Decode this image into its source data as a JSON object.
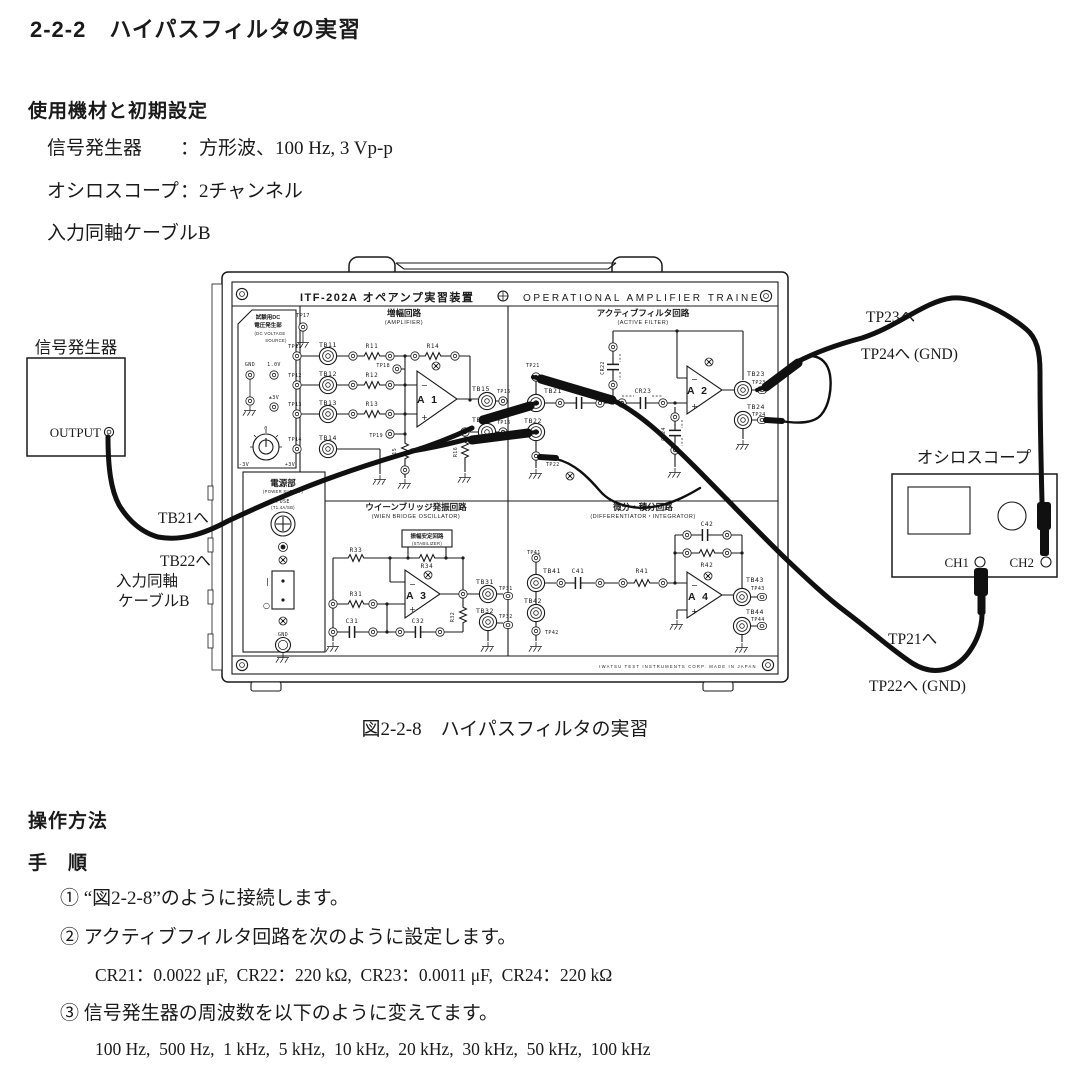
{
  "doc": {
    "title": "2-2-2　ハイパスフィルタの実習",
    "equipment_heading": "使用機材と初期設定",
    "equipment": [
      {
        "label": "信号発生器",
        "value": "：方形波、100 Hz, 3 Vp-p"
      },
      {
        "label": "オシロスコープ",
        "value": "：2チャンネル"
      },
      {
        "label": "入力同軸ケーブルB",
        "value": ""
      }
    ],
    "figure_caption": "図2-2-8　ハイパスフィルタの実習",
    "operation_heading": "操作方法",
    "procedure_heading": "手　順",
    "steps": {
      "s1": "① “図2-2-8”のように接続します。",
      "s2": "② アクティブフィルタ回路を次のように設定します。",
      "s2_detail": "CR21：0.0022 μF,  CR22：220 kΩ,  CR23：0.0011 μF,  CR24：220 kΩ",
      "s3": "③ 信号発生器の周波数を以下のように変えてます。",
      "s3_detail": "100 Hz,  500 Hz,  1 kHz,  5 kHz,  10 kHz,  20 kHz,  30 kHz,  50 kHz,  100 kHz"
    }
  },
  "L": {
    "itf": "ITF-202A オペアンプ実習装置",
    "oat": "OPERATIONAL AMPLIFIER TRAINER",
    "iwatsu": "IWATSU TEST INSTRUMENTS CORP.   MADE IN JAPAN",
    "dc_t1": "試験用DC",
    "dc_t2": "電圧発生部",
    "dc_t3": "(DC VOLTAGE",
    "dc_t4": "SOURCE)",
    "gnd": "GND",
    "v10": "1.0V",
    "pm3": "±3V",
    "m3": "-3V",
    "p3": "+3V",
    "zero": "0",
    "pw_t": "電源部",
    "pw_e": "(POWER SUPPLY)",
    "fuse": "FUSE",
    "fuse_r": "(T1.4A/SB)",
    "sw_on": "|",
    "sw_off": "○",
    "gnd2": "GND",
    "amp_t": "増幅回路",
    "amp_e": "(AMPLIFIER)",
    "tp11": "TP11",
    "tp12": "TP12",
    "tp13": "TP13",
    "tp14": "TP14",
    "tp15": "TP15",
    "tp16": "TP16",
    "tp17": "TP17",
    "tp18": "TP18",
    "tp19": "TP19",
    "tb11": "TB11",
    "tb12": "TB12",
    "tb13": "TB13",
    "tb14": "TB14",
    "tb15": "TB15",
    "tb16": "TB16",
    "r11": "R11",
    "r12": "R12",
    "r13": "R13",
    "r14": "R14",
    "r15": "R15",
    "r16": "R16",
    "a1": "A 1",
    "af_t": "アクティブフィルタ回路",
    "af_e": "(ACTIVE FILTER)",
    "tp21": "TP21",
    "tp22": "TP22",
    "tp23": "TP23",
    "tp24": "TP24",
    "tb21": "TB21",
    "tb22": "TB22",
    "tb23": "TB23",
    "tb24": "TB24",
    "cr22": "CR22",
    "cr23": "CR23",
    "cr24": "CR24",
    "a2": "A 2",
    "wb_t": "ウイーンブリッジ発振回路",
    "wb_e": "(WIEN BRIDGE OSCILLATOR)",
    "stab": "振幅安定回路",
    "stab_e": "(STABILIZER)",
    "r31": "R31",
    "r32": "R32",
    "r33": "R33",
    "r34": "R34",
    "c31": "C31",
    "c32": "C32",
    "tb31": "TB31",
    "tb32": "TB32",
    "tp31": "TP31",
    "tp32": "TP32",
    "a3": "A 3",
    "di_t": "微分・積分回路",
    "di_e": "(DIFFERENTIATOR・INTEGRATOR)",
    "c41": "C41",
    "c42": "C42",
    "r41": "R41",
    "r42": "R42",
    "tb41": "TB41",
    "tb42": "TB42",
    "tb43": "TB43",
    "tb44": "TB44",
    "tp41": "TP41",
    "tp42": "TP42",
    "tp43": "TP43",
    "tp44": "TP44",
    "a4": "A 4",
    "sg": "信号発生器",
    "out": "OUTPUT",
    "osc": "オシロスコープ",
    "ch1": "CH1",
    "ch2": "CH2",
    "lbl_tb21": "TB21へ",
    "lbl_tb22": "TB22へ",
    "lbl_coax1": "入力同軸",
    "lbl_coax2": "ケーブルB",
    "lbl_tp23": "TP23へ",
    "lbl_tp24": "TP24へ (GND)",
    "lbl_tp21": "TP21へ",
    "lbl_tp22": "TP22へ (GND)"
  },
  "colors": {
    "ink": "#1a1a1a",
    "cable": "#101010"
  }
}
